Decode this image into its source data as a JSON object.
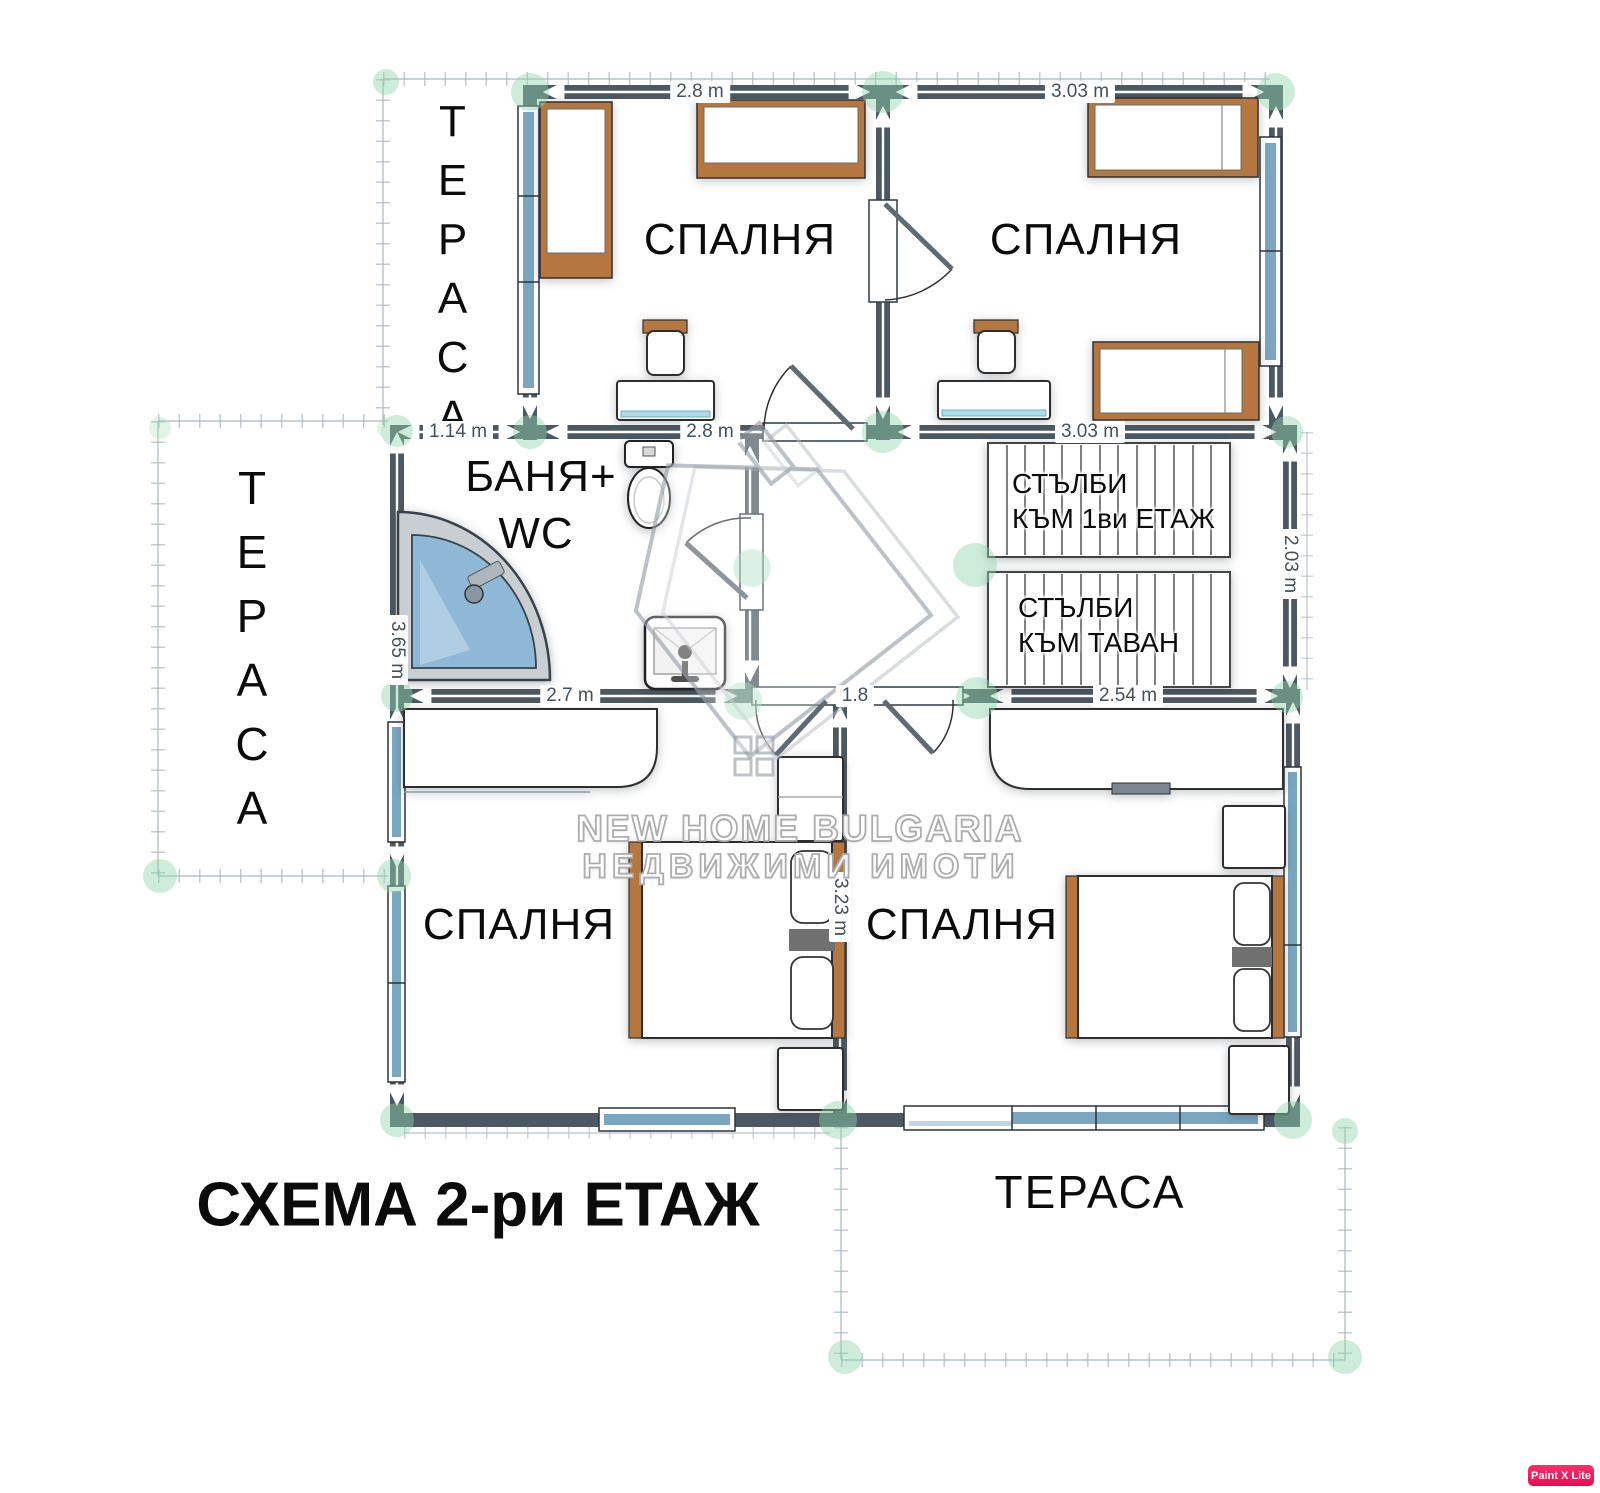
{
  "title": "СХЕМА 2-ри ЕТАЖ",
  "rooms": {
    "bedroom_top_left": "СПАЛНЯ",
    "bedroom_top_right": "СПАЛНЯ",
    "bedroom_bottom_left": "СПАЛНЯ",
    "bedroom_bottom_right": "СПАЛНЯ",
    "bathroom_line1": "БАНЯ+",
    "bathroom_line2": "WC",
    "terrace_top_left": "ТЕРАСА",
    "terrace_left": "ТЕРАСА",
    "terrace_bottom_right": "ТЕРАСА"
  },
  "stairs": {
    "to_first_floor_line1": "СТЪЛБИ",
    "to_first_floor_line2": "КЪМ 1ви ЕТАЖ",
    "to_attic_line1": "СТЪЛБИ",
    "to_attic_line2": "КЪМ ТАВАН"
  },
  "dimensions": {
    "top_bedroom_left_width": "2.8 m",
    "top_bedroom_right_width": "3.03 m",
    "terrace_strip_width": "1.14 m",
    "mid_bedroom_left_width": "2.8 m",
    "mid_bedroom_right_width": "3.03 m",
    "bathroom_height": "3.65 m",
    "stairs_height": "2.03 m",
    "bathroom_width": "2.7 m",
    "hall_width": "1.8",
    "stairs_width": "2.54 m",
    "bottom_bedroom_height": "3.23 m"
  },
  "watermark": {
    "line1": "NEW HOME BULGARIA",
    "line2": "НЕДВИЖИМИ ИМОТИ"
  },
  "badge": {
    "label": "Paint X Lite"
  },
  "colors": {
    "wall": "#4c5862",
    "window_glass": "#7aa6bf",
    "furniture_wood": "#b5773f",
    "shower_glass": "#8fb8d6",
    "corner_marker": "#8fd4ad",
    "badge_bg": "#ec0a51"
  }
}
